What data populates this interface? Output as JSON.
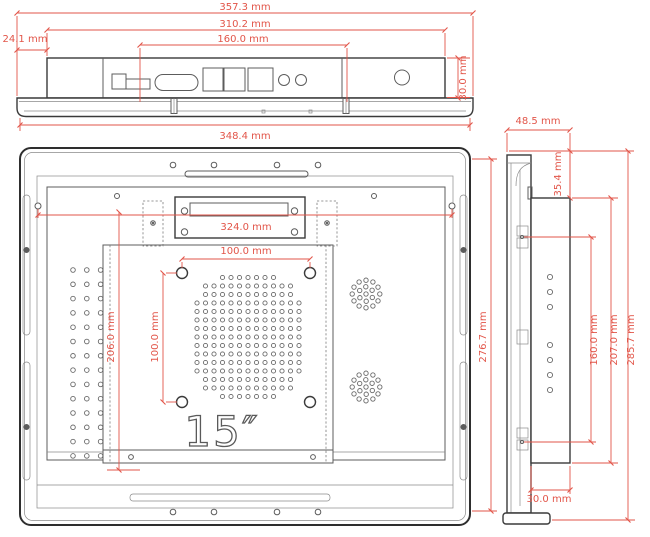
{
  "drawing": {
    "title": "15-inch open-frame monitor dimensional drawing",
    "unit": "mm",
    "screen_size_label": "15″",
    "colors": {
      "dimension": "#e25549",
      "ink": "#3a3a3a",
      "background": "#ffffff"
    },
    "views": {
      "top_view": {
        "dimensions": {
          "overall_width": "357.3 mm",
          "chassis_width": "310.2 mm",
          "port_span": "160.0 mm",
          "left_offset": "24.1 mm",
          "chassis_depth": "30.0 mm",
          "back_cover_width": "348.4 mm"
        }
      },
      "back_view": {
        "screen_size_label": "15″",
        "dimensions": {
          "bracket_span": "324.0 mm",
          "vesa_width": "100.0 mm",
          "vesa_height": "100.0 mm",
          "bracket_to_base": "206.0 mm",
          "panel_height": "276.7 mm"
        }
      },
      "side_view": {
        "dimensions": {
          "overall_depth": "48.5 mm",
          "top_inset": "35.4 mm",
          "mount_hole_span": "160.0 mm",
          "rear_cover_height": "207.0 mm",
          "overall_height": "285.7 mm",
          "rear_cover_bottom_depth": "30.0 mm"
        }
      }
    }
  }
}
